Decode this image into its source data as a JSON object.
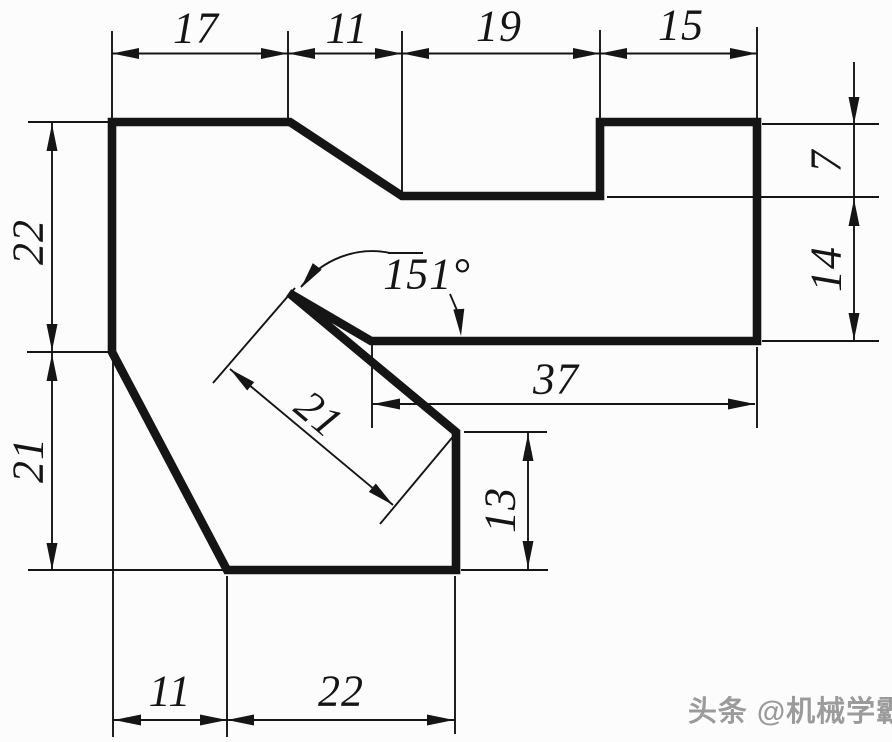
{
  "drawing": {
    "background": "#fcfcfc",
    "line_color": "#151515",
    "outline_points": "112,122 290,122 402,196 600,196 600,122 757,122 757,341 371,341 289,293 456,432 456,570 227,570 112,352",
    "dimensions": {
      "top_17": "17",
      "top_11": "11",
      "top_19": "19",
      "top_15": "15",
      "left_22": "22",
      "left_21": "21",
      "right_7": "7",
      "right_14": "14",
      "width_37": "37",
      "angle_151": "151°",
      "slot_21": "21",
      "depth_13": "13",
      "bottom_11": "11",
      "bottom_22": "22"
    }
  },
  "watermark": {
    "text": "头条 @机械学霸",
    "color": "#9b9b9b",
    "highlight": "#ffffff"
  }
}
